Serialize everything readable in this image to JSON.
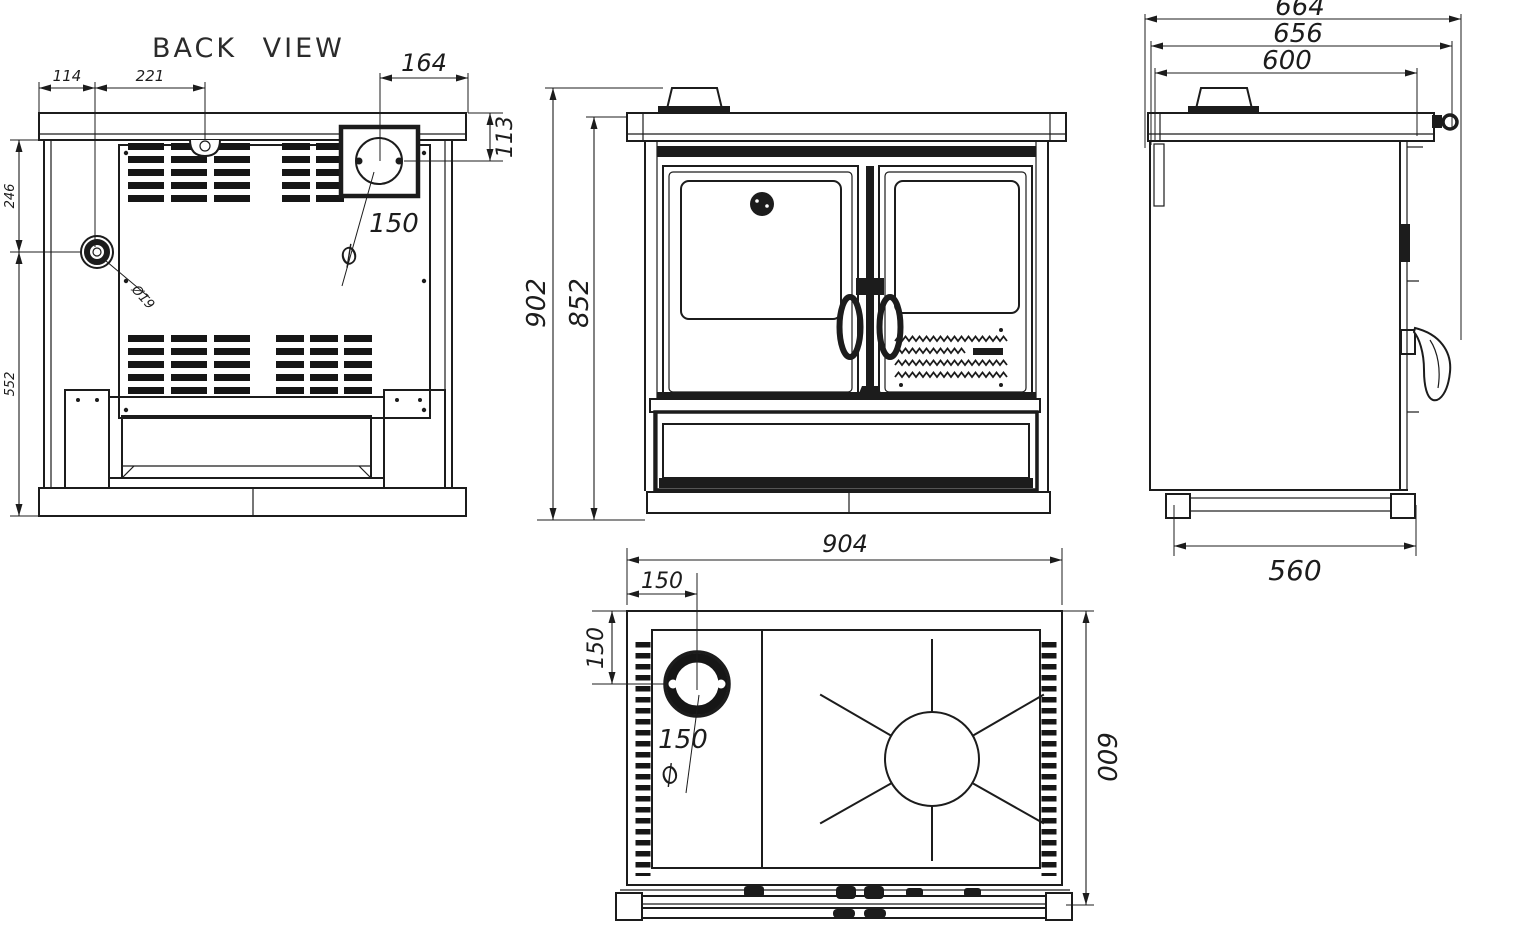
{
  "drawing": {
    "bg_color": "#ffffff",
    "line_color": "#1c1c1c",
    "views": {
      "back": {
        "label": "BACK VIEW",
        "dim_left_offset": "114",
        "dim_clamp_offset": "221",
        "dim_flue_offset": "164",
        "dim_flue_drop": "113",
        "dim_upper_height": "246",
        "dim_lower_height": "552",
        "flue_diameter": "150",
        "diameter_symbol": "Ø",
        "knob_label": "Ø19"
      },
      "front": {
        "dim_total_height": "902",
        "dim_body_height": "852"
      },
      "side": {
        "dim_total_depth": "664",
        "dim_mid_depth": "656",
        "dim_top_depth": "600",
        "dim_base_depth": "560"
      },
      "top": {
        "dim_width": "904",
        "dim_flue_x": "150",
        "dim_flue_y": "150",
        "flue_diameter": "150",
        "diameter_symbol": "Ø",
        "dim_depth": "600"
      }
    }
  }
}
